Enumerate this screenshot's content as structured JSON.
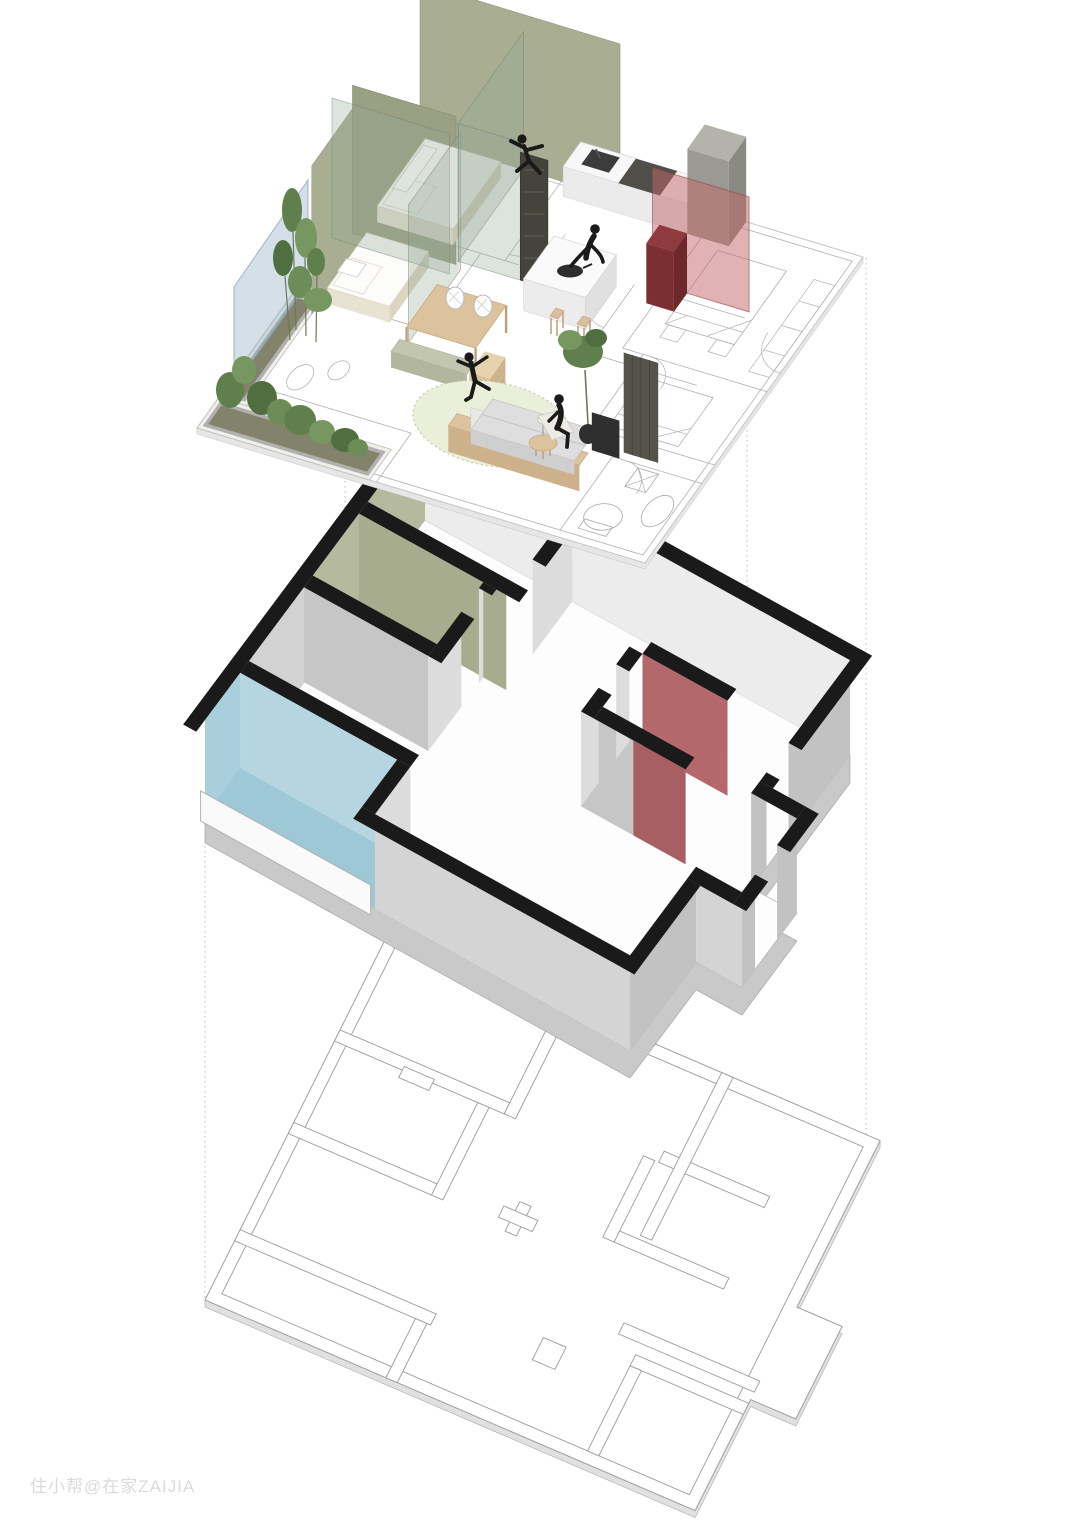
{
  "watermark": {
    "text": "住小帮@在家ZAIJIA"
  },
  "diagram": {
    "type": "exploded-axonometric-floor-plan",
    "layer_ids": [
      "furnished-interior-layer",
      "wall-structure-layer",
      "original-structure-plan-layer"
    ]
  },
  "palette": {
    "olive_wall": "#a9ae93",
    "olive_wall_dark": "#9aa083",
    "accent_blue": "#a9cfdd",
    "accent_blue_floor": "#9fc8d6",
    "accent_red": "#b4686c",
    "wall_cap_black": "#1a1a1a",
    "wall_gray_light": "#dcdcdc",
    "wall_gray_dark": "#c2c2c2",
    "wood_tan": "#d9bf9a",
    "rug_green": "#e9efd9",
    "plant_green": "#5f7f4d",
    "plan_line_gray": "#9b9b9b",
    "people_silhouette": "#1a1a1a"
  }
}
